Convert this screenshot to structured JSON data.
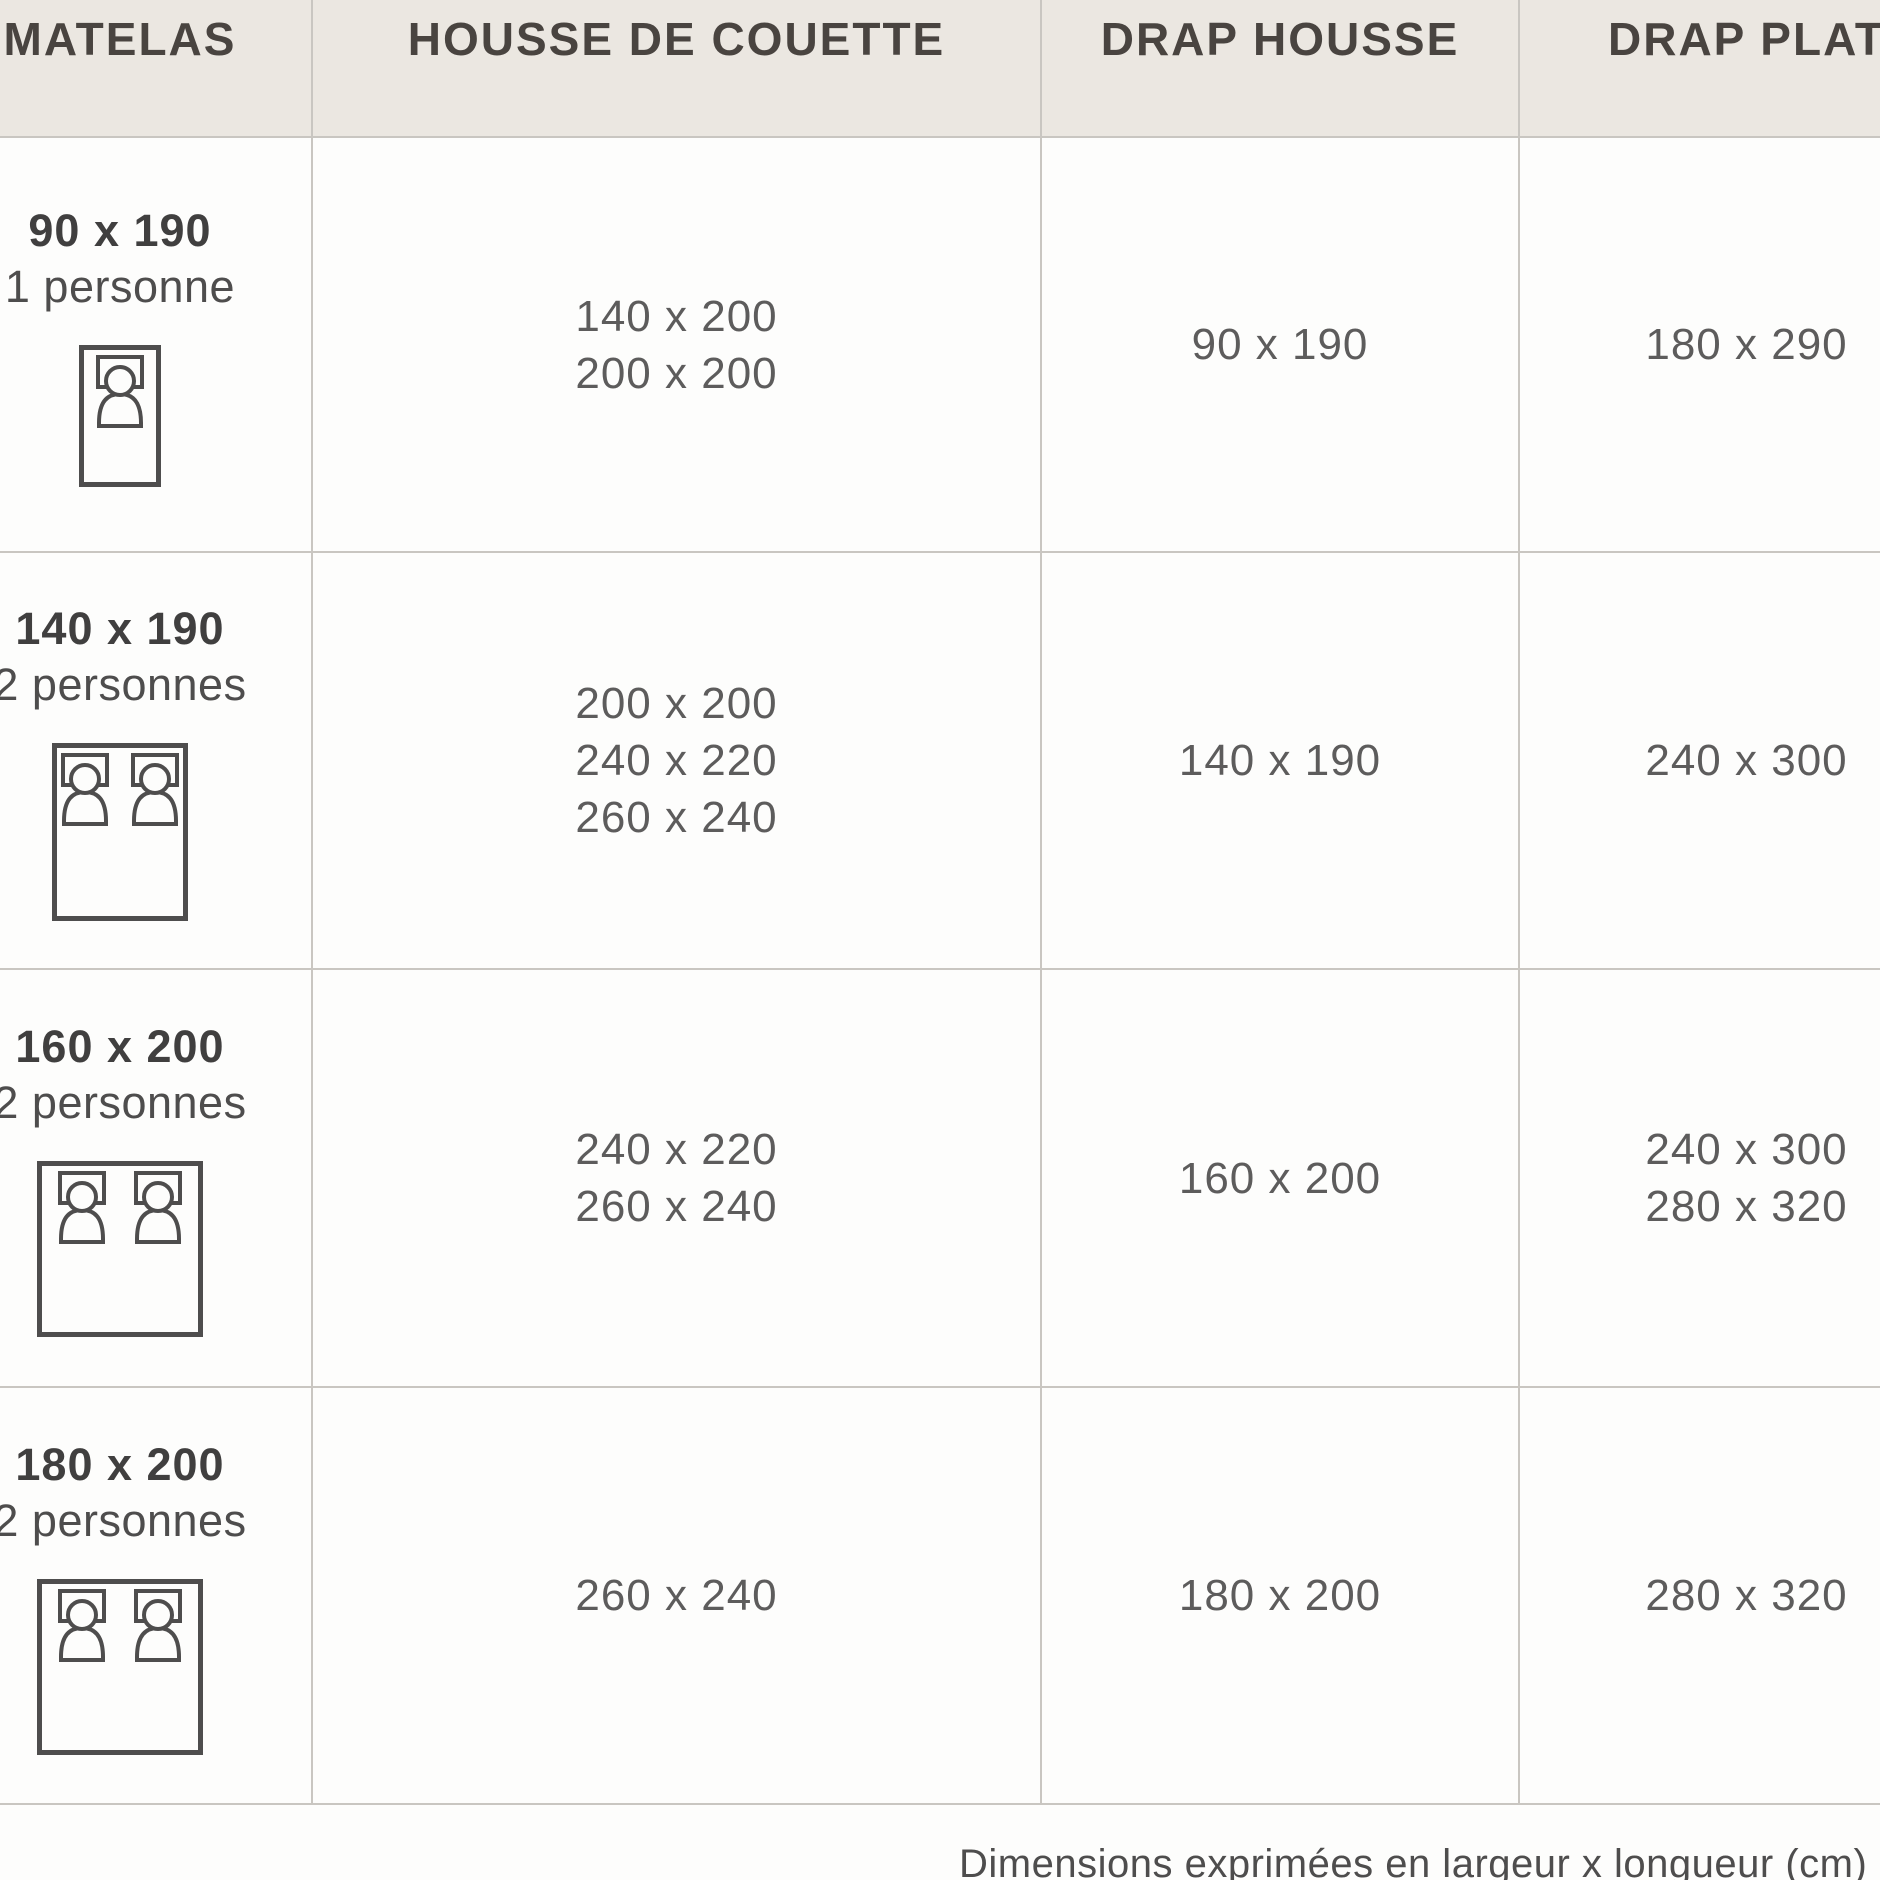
{
  "page": {
    "background": "#fdfdfc"
  },
  "table": {
    "columns": [
      "MATELAS",
      "HOUSSE DE COUETTE",
      "DRAP HOUSSE",
      "DRAP PLAT"
    ],
    "rows": [
      {
        "matelas_size": "90 x 190",
        "matelas_type": "1 personne",
        "icon": "bed-1-person-icon",
        "housse_de_couette": [
          "140 x 200",
          "200 x 200"
        ],
        "drap_housse": [
          "90 x 190"
        ],
        "drap_plat": [
          "180 x 290"
        ]
      },
      {
        "matelas_size": "140 x 190",
        "matelas_type": "2 personnes",
        "icon": "bed-2-persons-icon",
        "housse_de_couette": [
          "200 x 200",
          "240 x 220",
          "260 x 240"
        ],
        "drap_housse": [
          "140 x 190"
        ],
        "drap_plat": [
          "240 x 300"
        ]
      },
      {
        "matelas_size": "160 x 200",
        "matelas_type": "2 personnes",
        "icon": "bed-2-persons-icon",
        "housse_de_couette": [
          "240 x 220",
          "260 x 240"
        ],
        "drap_housse": [
          "160 x 200"
        ],
        "drap_plat": [
          "240 x 300",
          "280 x 320"
        ]
      },
      {
        "matelas_size": "180 x 200",
        "matelas_type": "2 personnes",
        "icon": "bed-2-persons-icon",
        "housse_de_couette": [
          "260 x 240"
        ],
        "drap_housse": [
          "180 x 200"
        ],
        "drap_plat": [
          "280 x 320"
        ]
      }
    ],
    "footer_note": "Dimensions exprimées en largeur x longueur (cm)"
  },
  "colors": {
    "header_bg": "#ebe7e1",
    "body_bg": "#fdfdfc",
    "border": "#c9c6c1",
    "header_text": "#494440",
    "size_label_text": "#403f3f",
    "type_text": "#4e4d4d",
    "value_text": "#5d5c5c",
    "icon_stroke": "#4e4d4d"
  }
}
